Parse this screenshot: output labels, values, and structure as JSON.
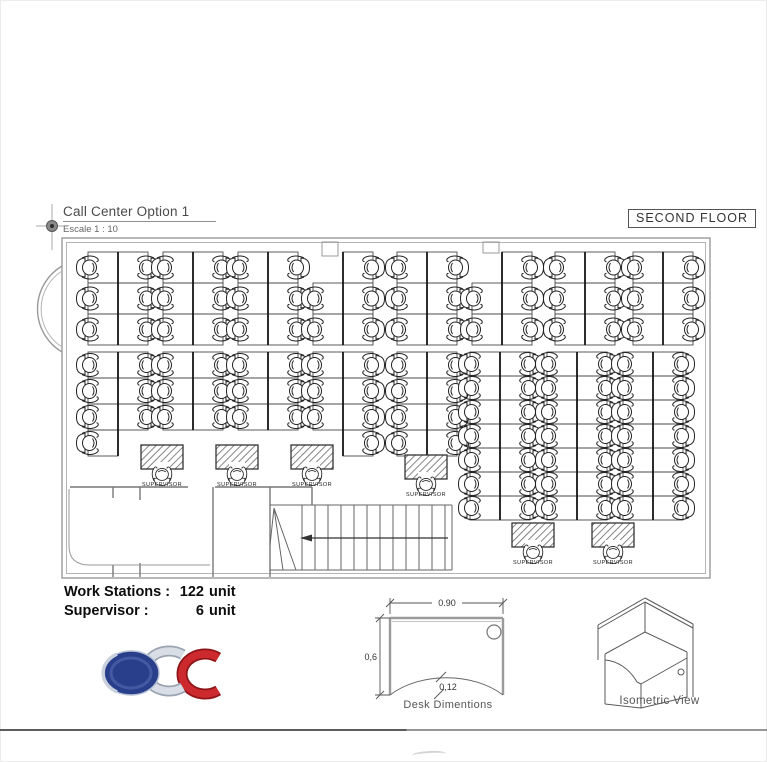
{
  "drawing": {
    "title": "Call Center Option 1",
    "scale": "Escale 1 : 10",
    "floor_label": "SECOND FLOOR"
  },
  "summary": {
    "rows": [
      {
        "label": "Work Stations :",
        "value": "122",
        "unit": "unit"
      },
      {
        "label": "Supervisor :",
        "value": "6",
        "unit": "unit"
      }
    ]
  },
  "plan": {
    "workstation_total": 122,
    "supervisor_total": 6,
    "supervisor_label": "SUPERVISOR",
    "cell": {
      "w": 30
    },
    "clusters": [
      {
        "x": 88,
        "y": 252,
        "rows": 3,
        "h": 31
      },
      {
        "x": 163,
        "y": 252,
        "rows": 3,
        "h": 31
      },
      {
        "x": 238,
        "y": 252,
        "rows": 3,
        "h": 31
      },
      {
        "x": 313,
        "y": 252,
        "rows": 3,
        "h": 31,
        "skip": [
          "0L"
        ]
      },
      {
        "x": 397,
        "y": 252,
        "rows": 3,
        "h": 31
      },
      {
        "x": 472,
        "y": 252,
        "rows": 3,
        "h": 31,
        "skip": [
          "0L"
        ]
      },
      {
        "x": 555,
        "y": 252,
        "rows": 3,
        "h": 31
      },
      {
        "x": 633,
        "y": 252,
        "rows": 3,
        "h": 31
      },
      {
        "x": 88,
        "y": 352,
        "rows": 4,
        "h": 26,
        "skip": [
          "3R"
        ]
      },
      {
        "x": 163,
        "y": 352,
        "rows": 3,
        "h": 26
      },
      {
        "x": 238,
        "y": 352,
        "rows": 3,
        "h": 26
      },
      {
        "x": 313,
        "y": 352,
        "rows": 4,
        "h": 26,
        "skip": [
          "3L"
        ]
      },
      {
        "x": 397,
        "y": 352,
        "rows": 4,
        "h": 26
      },
      {
        "x": 470,
        "y": 352,
        "rows": 7,
        "h": 24
      },
      {
        "x": 547,
        "y": 352,
        "rows": 7,
        "h": 24
      },
      {
        "x": 623,
        "y": 352,
        "rows": 7,
        "h": 24
      }
    ],
    "supervisors": [
      {
        "x": 141,
        "y": 445
      },
      {
        "x": 216,
        "y": 445
      },
      {
        "x": 291,
        "y": 445
      },
      {
        "x": 405,
        "y": 455
      },
      {
        "x": 512,
        "y": 523
      },
      {
        "x": 592,
        "y": 523
      }
    ]
  },
  "desk_diagram": {
    "width_label": "0.90",
    "depth_label": "0,6",
    "curve_label": "0,12",
    "caption": "Desk Dimentions"
  },
  "isometric": {
    "caption": "Isometric View"
  },
  "logo": {
    "text": "CDC",
    "blue": "#2a3f8c",
    "silver": "#d8dde6",
    "red": "#c1272d"
  },
  "colors": {
    "line": "#555555",
    "wall": "#9a9a9a",
    "text": "#4a4a4a",
    "partition": "#151515"
  }
}
